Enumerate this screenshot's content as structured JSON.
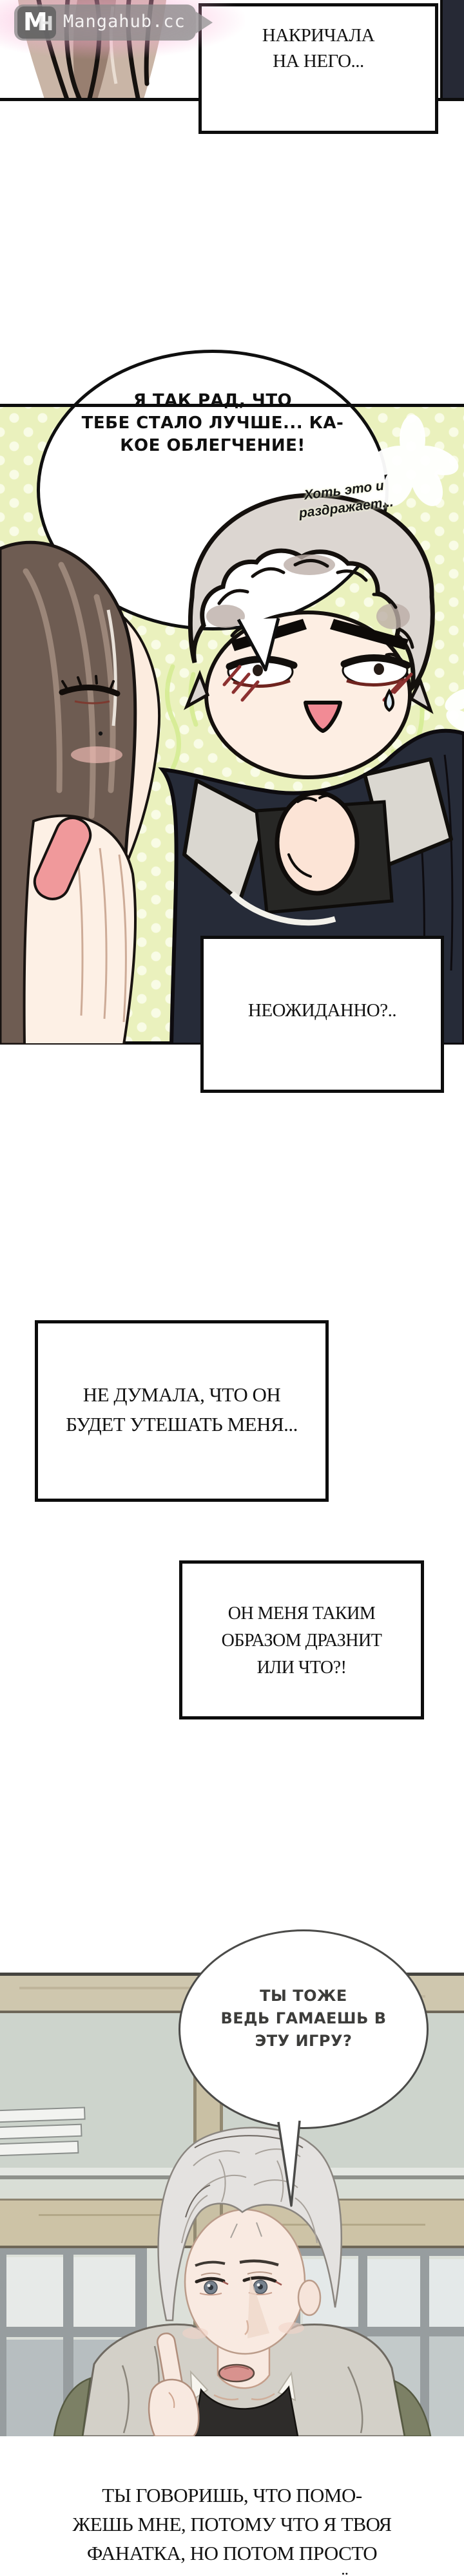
{
  "watermark": {
    "logo_m": "M",
    "logo_h": "H",
    "site": "Mangahub.cc"
  },
  "captions": {
    "yelled": {
      "lines": [
        "НАКРИЧАЛА",
        "НА НЕГО..."
      ]
    },
    "unexpected": {
      "text": "НЕОЖИДАННО?.."
    },
    "thought": {
      "lines": [
        "НЕ ДУМАЛА, ЧТО ОН",
        "БУДЕТ УТЕШАТЬ МЕНЯ..."
      ]
    },
    "teasing": {
      "lines": [
        "ОН МЕНЯ ТАКИМ",
        "ОБРАЗОМ ДРАЗНИТ",
        "ИЛИ ЧТО?!"
      ]
    },
    "narration": {
      "lines": [
        "ТЫ ГОВОРИШЬ, ЧТО ПОМО-",
        "ЖЕШЬ МНЕ, ПОТОМУ ЧТО Я ТВОЯ",
        "ФАНАТКА, НО ПОТОМ ПРОСТО",
        "РЕШАЕШЬ ПОЗВОЛЯТЬ ЕЁ?"
      ]
    }
  },
  "speech": {
    "glad": {
      "lines": [
        "Я ТАК РАД, ЧТО",
        "ТЕБЕ СТАЛО ЛУЧШЕ... КА-",
        "КОЕ ОБЛЕГЧЕНИЕ!"
      ]
    },
    "aside": {
      "lines": [
        "Хоть это и",
        "раздражает..."
      ]
    },
    "game": {
      "lines": [
        "ТЫ ТОЖЕ",
        "ВЕДЬ ГАМАЕШЬ В",
        "ЭТУ ИГРУ?"
      ]
    }
  },
  "colors": {
    "ink": "#0f0f0f",
    "paper": "#ffffff",
    "panel2_bg": "#eaf1bd",
    "panel2_dot": "#f9fce6",
    "watermark_glow": "#f9aad2",
    "bubble2_outline": "#4b4b49",
    "beam_wood": "#cdc3a6",
    "wall_green": "#cdd4cc"
  }
}
